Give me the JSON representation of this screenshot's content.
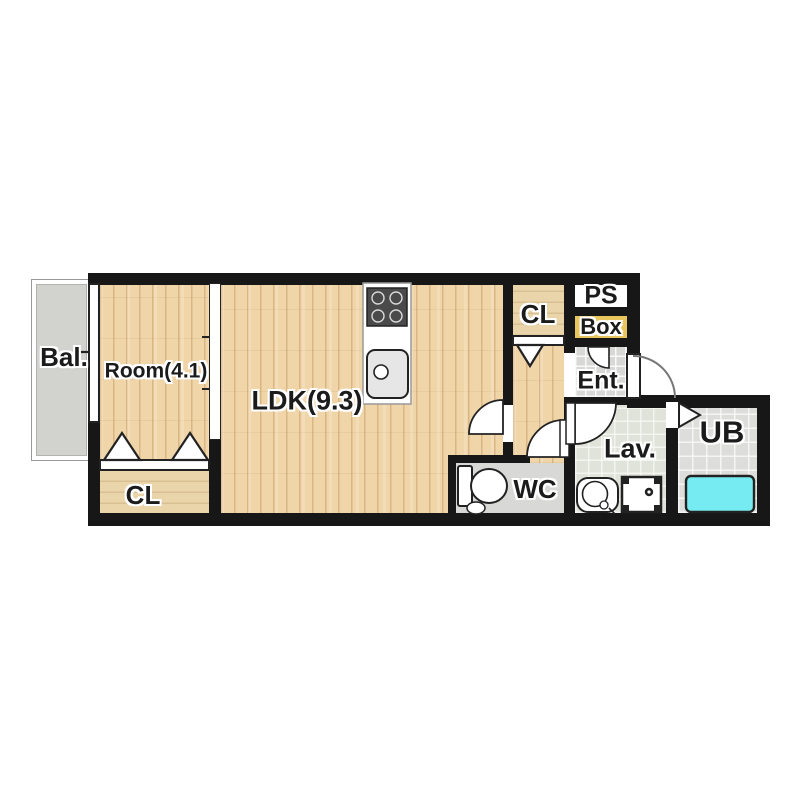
{
  "title": "apartment-floor-plan",
  "colors": {
    "wall": "#171717",
    "wood": "#f0d5a8",
    "closet": "#ead5ab",
    "balcony": "#d2d2ce",
    "tile_gray": "#d8d8d6",
    "lav_floor": "#e0e3d9",
    "ub_floor": "#dddedb",
    "wc_floor": "#d8d8d6",
    "tub": "#76ecf2",
    "box": "#e9c55e",
    "ps": "#ffffff"
  },
  "rooms": {
    "balcony": {
      "label": "Bal."
    },
    "bedroom": {
      "label": "Room(4.1)"
    },
    "ldk": {
      "label": "LDK(9.3)"
    },
    "closet_bedroom": {
      "label": "CL"
    },
    "closet_hall": {
      "label": "CL"
    },
    "pipe_shaft": {
      "label": "PS"
    },
    "shoe_box": {
      "label": "Box"
    },
    "entrance": {
      "label": "Ent."
    },
    "lavatory": {
      "label": "Lav."
    },
    "unit_bath": {
      "label": "UB"
    },
    "toilet": {
      "label": "WC"
    }
  },
  "fixtures": [
    "stove-icon",
    "kitchen-sink-icon",
    "toilet-icon",
    "washbasin-icon",
    "washing-machine-icon",
    "bathtub-icon",
    "door-swing-arc",
    "closet-folding-door-triangle",
    "sliding-window",
    "sliding-door",
    "entrance-door-arc",
    "unit-bath-door-triangle"
  ]
}
